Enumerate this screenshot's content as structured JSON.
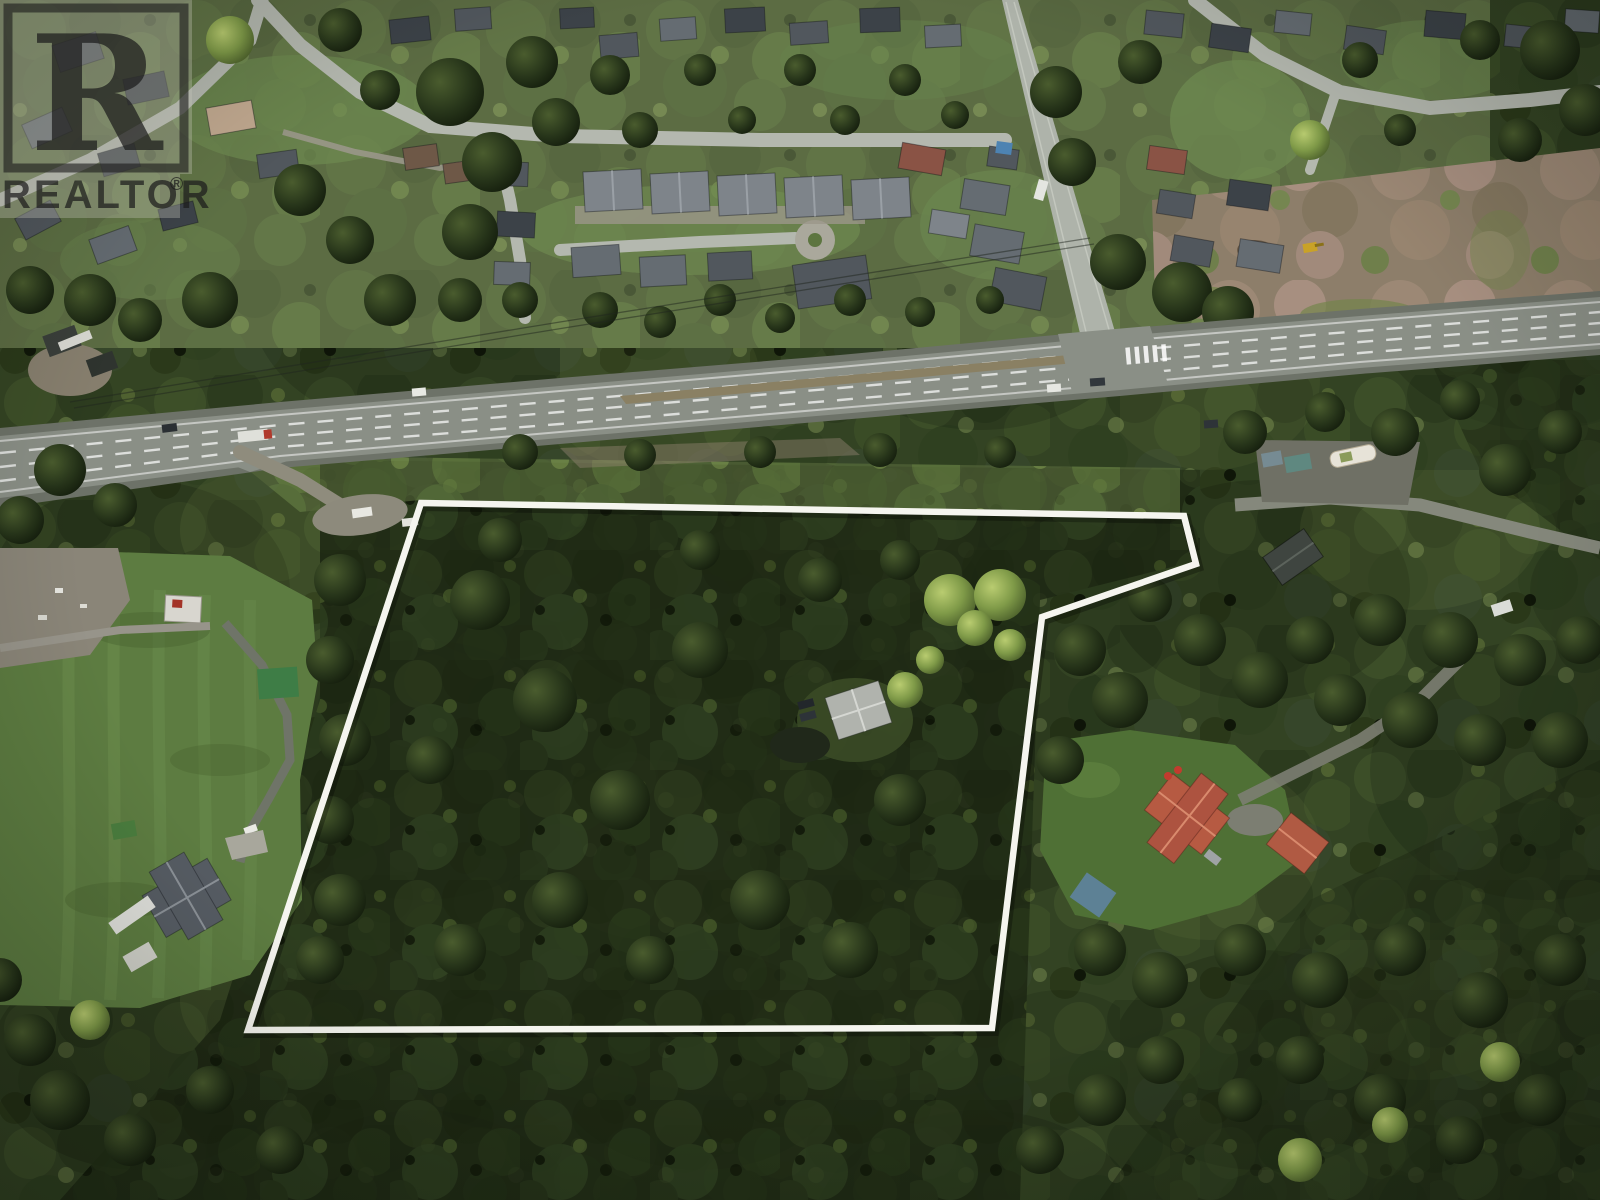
{
  "watermark": {
    "brand": "REALTOR",
    "registered_symbol": "®",
    "logo_letter": "R",
    "ink_color": "#1c1c1c",
    "panel_opacity": 0.34
  },
  "property_outline": {
    "color": "#f5f5ef",
    "stroke_width": 6.5,
    "points": "421,503 1184,516 1196,564 1042,617 992,1028 248,1030"
  },
  "palette": {
    "forest_dark": "#1d2713",
    "forest_mid": "#334323",
    "forest_light": "#55663a",
    "meadow_green": "#5d7c41",
    "highway_asphalt": "#8a8f86",
    "street_gray": "#b4b8af",
    "gravel": "#8f8c7d",
    "clearcut_brown": "#8d7e6a",
    "red_roof": "#b65a42",
    "blue_roof": "#5d8195",
    "boundary_white": "#f5f5ef"
  }
}
